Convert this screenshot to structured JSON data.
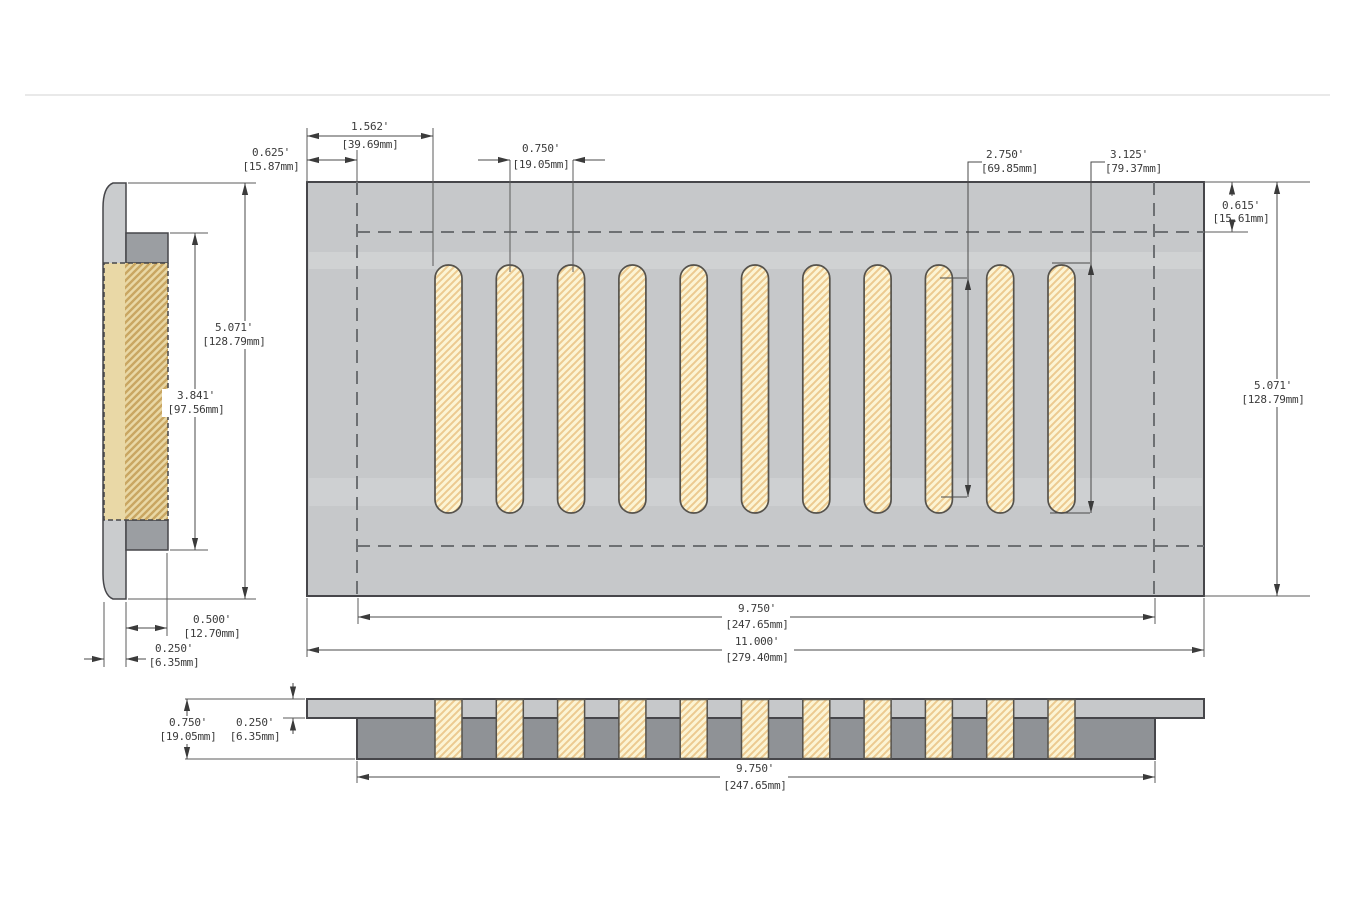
{
  "drawing": {
    "description": "floor vent register dimension drawing",
    "slots": {
      "count": 11
    },
    "colors": {
      "plate_gray": "#c6c8ca",
      "side_face_gray": "#caccce",
      "flange_gray": "#9b9ea2",
      "body_gray": "#8f9296",
      "slot_cream": "#fcf4d4",
      "slot_hatch": "#ecca90",
      "side_tan": "#e9d8a6",
      "side_hatch": "#c9a662",
      "outline": "#46464a",
      "dimension": "#4a4a4a"
    },
    "dims": {
      "side_height": {
        "in": "5.071'",
        "mm": "[128.79mm]"
      },
      "side_inner": {
        "in": "3.841'",
        "mm": "[97.56mm]"
      },
      "side_depth": {
        "in": "0.500'",
        "mm": "[12.70mm]"
      },
      "side_plate": {
        "in": "0.250'",
        "mm": "[6.35mm]"
      },
      "top_edge_offset": {
        "in": "0.625'",
        "mm": "[15.87mm]"
      },
      "top_first_slot": {
        "in": "1.562'",
        "mm": "[39.69mm]"
      },
      "top_slot_pitch": {
        "in": "0.750'",
        "mm": "[19.05mm]"
      },
      "top_slot_straight": {
        "in": "2.750'",
        "mm": "[69.85mm]"
      },
      "top_slot_length": {
        "in": "3.125'",
        "mm": "[79.37mm]"
      },
      "top_top_offset": {
        "in": "0.615'",
        "mm": "[15.61mm]"
      },
      "top_height": {
        "in": "5.071'",
        "mm": "[128.79mm]"
      },
      "top_opening": {
        "in": "9.750'",
        "mm": "[247.65mm]"
      },
      "top_overall": {
        "in": "11.000'",
        "mm": "[279.40mm]"
      },
      "sec_total_h": {
        "in": "0.750'",
        "mm": "[19.05mm]"
      },
      "sec_plate_h": {
        "in": "0.250'",
        "mm": "[6.35mm]"
      },
      "sec_body_w": {
        "in": "9.750'",
        "mm": "[247.65mm]"
      }
    }
  }
}
